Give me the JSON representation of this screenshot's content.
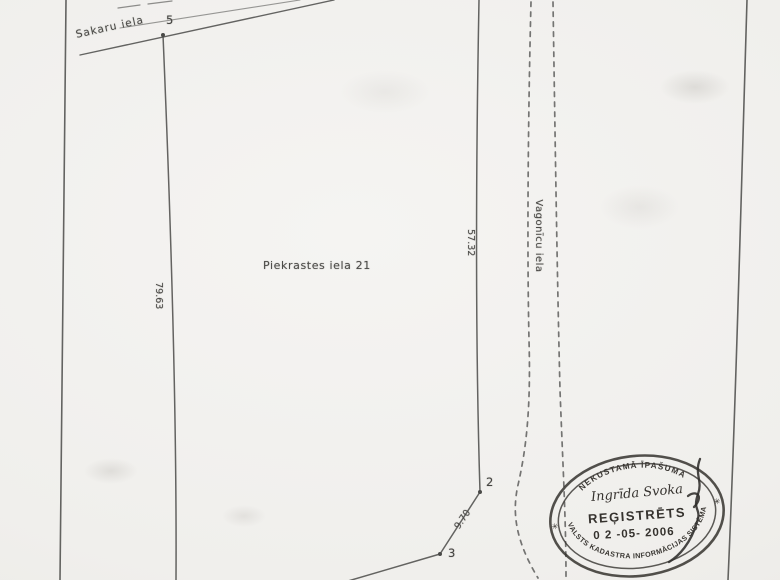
{
  "plan": {
    "parcel_label": "Piekrastes iela 21",
    "street_top": "Sakaru iela",
    "street_right": "Vagonīcu iela",
    "dimensions": {
      "west": "79.63",
      "east": "57.32",
      "south": "9.70"
    },
    "points": {
      "top": "5",
      "east": "2",
      "south": "3"
    }
  },
  "stamp": {
    "arc_top": "NEKUSTAMĀ ĪPAŠUMA",
    "owner": "Ingrīda Svoka",
    "status": "REĢISTRĒTS",
    "date": "0 2 -05- 2006",
    "arc_bottom": "VALSTS KADASTRA INFORMĀCIJAS SISTĒMA",
    "star": "✳"
  },
  "colors": {
    "paper": "#f0efec",
    "ink": "#4a4a48",
    "stamp_ink": "#35322e"
  }
}
